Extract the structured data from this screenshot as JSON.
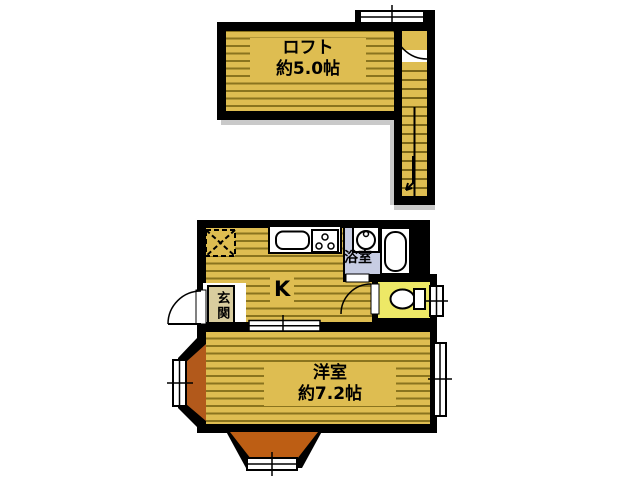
{
  "figure": {
    "type": "floor-plan",
    "floors": [
      "loft-level",
      "main-level"
    ]
  },
  "rooms": {
    "loft": {
      "name": "ロフト",
      "size": "約5.0帖"
    },
    "kitchen": {
      "label": "K"
    },
    "bathroom": {
      "label": "浴室"
    },
    "entrance": {
      "label": "玄関"
    },
    "western": {
      "name": "洋室",
      "size": "約7.2帖"
    }
  },
  "fixtures": [
    "staircase-icon",
    "stair-direction-arrow-icon",
    "door-swing-icon",
    "sliding-door-icon",
    "window-icon",
    "bay-window-icon",
    "refrigerator-space-icon",
    "sink-icon",
    "gas-stove-icon",
    "washing-machine-icon",
    "bathtub-icon",
    "toilet-icon"
  ],
  "colors": {
    "floor_tan": "#DEBD51",
    "stripe_dark": "#8A741E",
    "wall_black": "#000000",
    "bathroom_blue": "#C7CDE3",
    "toilet_yellow": "#EDE866",
    "bay_brown": "#B2591B",
    "bay_brown_bottom": "#BD5E14",
    "entrance_box_tan": "#D9CD9E",
    "shadow_gray": "#C9C9C9"
  }
}
